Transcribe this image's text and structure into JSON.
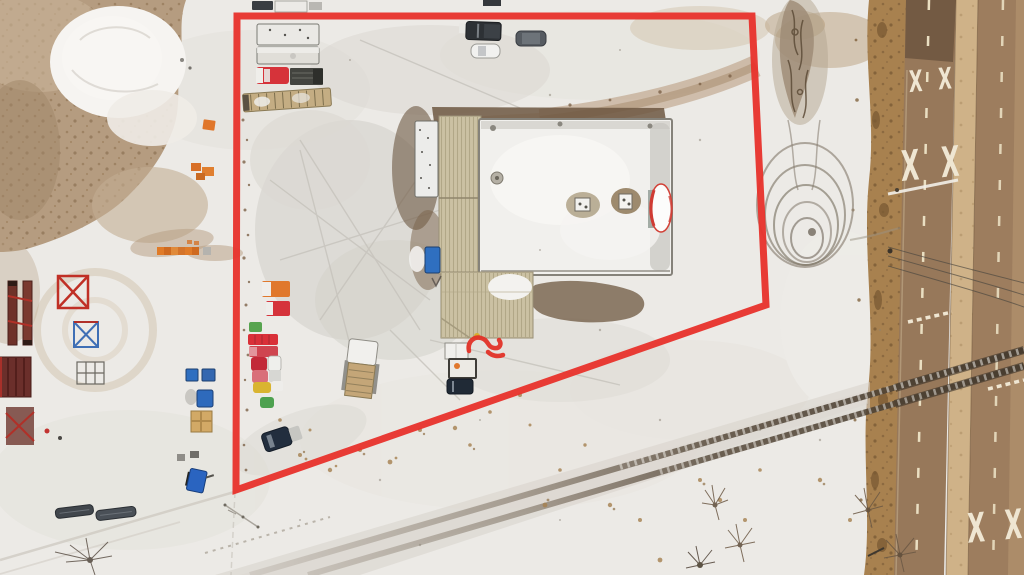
{
  "scene": {
    "alt_text": "Winter aerial drone photo of an industrial yard outlined by a red property boundary; a large building with a partially snow-covered roof sits in the middle, rows of trucks and trailers are parked along the left, a railway line crosses the lower right diagonally and a brown two-lane highway with painted railway-crossing X markings runs along the right edge."
  },
  "boundary": {
    "points": "237,16 752,16 766,305 236,490",
    "color": "#e8312b",
    "stroke_width": 7
  },
  "road": {
    "pavement_markings": [
      "X X",
      "X X",
      "X X"
    ]
  },
  "colors": {
    "snow": "#eceae6",
    "snow_bright": "#f6f4f1",
    "snow_trampled": "#d6d3cc",
    "field_brown": "#b59c80",
    "field_brown_light": "#c8b398",
    "dirt_dark": "#6d5741",
    "dirt_path": "#b29070",
    "roof_tan": "#cbc1a3",
    "roof_snow": "#f1f0ed",
    "roof_edge_green": "#9aa29a",
    "trailer_white": "#ececea",
    "truck_red": "#d6333a",
    "cab_white": "#efeeea",
    "orange": "#e0782c",
    "yellow": "#d9b430",
    "green": "#4da14f",
    "blue": "#2f6fc0",
    "navy": "#222e3e",
    "road_asphalt": "#97785a",
    "road_asphalt_right": "#9d7d5e",
    "road_dark": "#6f5740",
    "road_median": "#cfb288",
    "road_shoulder": "#b69671",
    "roadside_vegetation": "#a8814f",
    "lane_dash": "#eadfc2",
    "pavement_marking": "#efe6d2",
    "rail_tie": "#efece6",
    "bush": "#a5804f",
    "tree": "#6b5844"
  }
}
